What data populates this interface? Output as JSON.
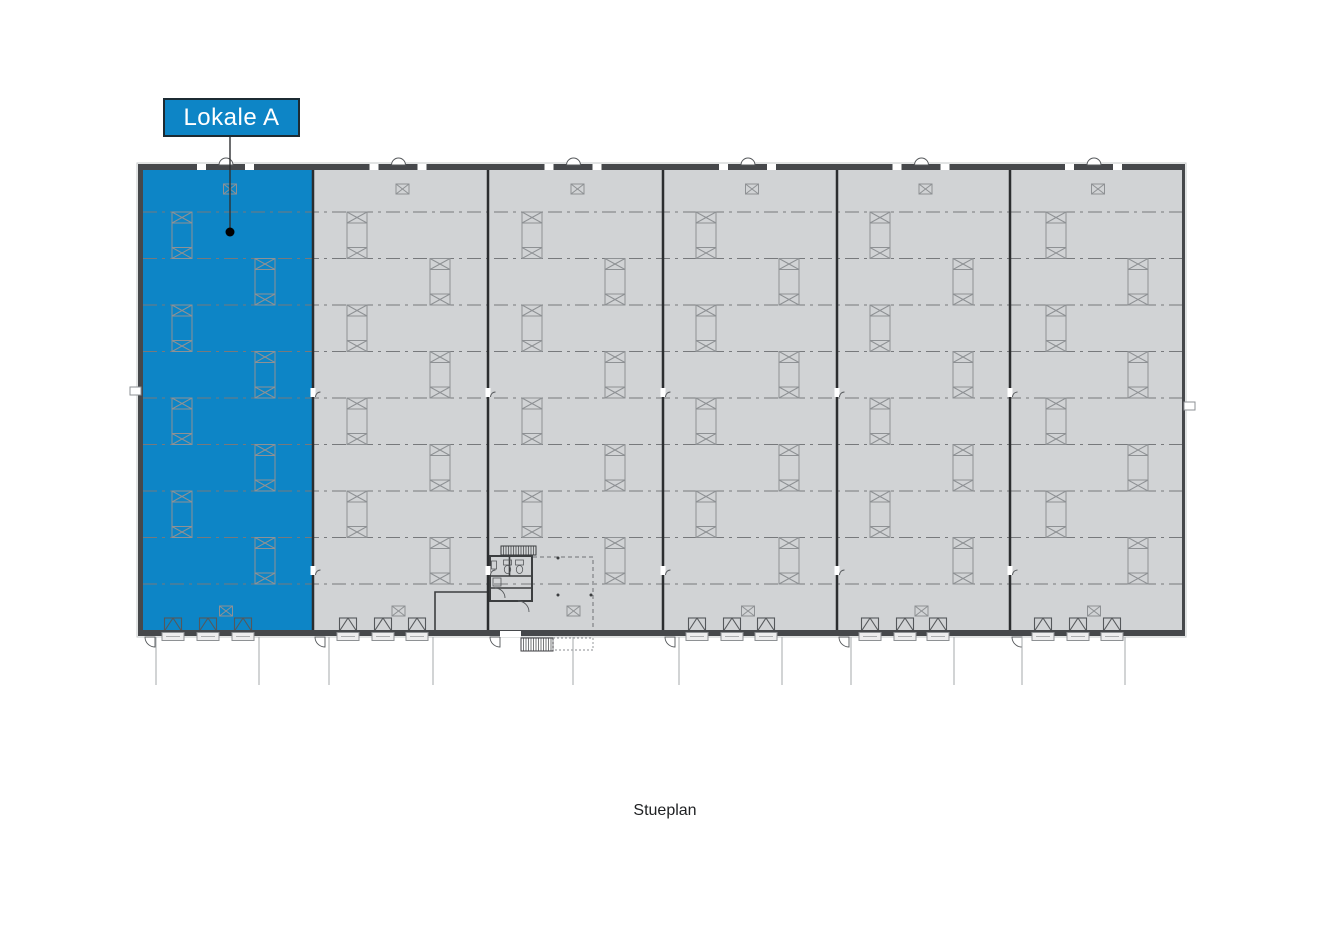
{
  "page": {
    "background": "#ffffff"
  },
  "label": {
    "text": "Lokale A",
    "text_color": "#ffffff",
    "fill": "#0d85c6",
    "border_color": "#1c2b33",
    "box": {
      "x": 163,
      "y": 98,
      "w": 137,
      "h": 39
    },
    "leader": {
      "x": 230,
      "y1": 137,
      "y2": 228,
      "dot_y": 232,
      "dot_r": 4.5
    }
  },
  "caption": {
    "text": "Stueplan",
    "x": 665,
    "y": 802
  },
  "plan": {
    "colors": {
      "highlight": "#0d85c6",
      "floor": "#d1d3d5",
      "wall": "#46484b",
      "wall_edge": "#c6c8ca",
      "divider": "#2b2d2f",
      "grid": "#77797c",
      "symbol": "#8e9194",
      "symbol_dark": "#55585b",
      "detail": "#3c3e40",
      "site_line": "#a4a8ab",
      "tray_fill": "#ededee",
      "leader": "#2e3032",
      "dot": "#000000"
    },
    "building": {
      "outer_x": 138,
      "outer_y": 164,
      "outer_w": 1047,
      "outer_h": 472,
      "wall": 6,
      "inner_x": 143,
      "inner_y": 170,
      "inner_r": 1182,
      "inner_b": 630
    },
    "grid": {
      "y_start": 212,
      "step": 46.5,
      "count": 9
    },
    "bays": [
      {
        "left": 143,
        "right": 313,
        "highlighted": true,
        "col_a": 182,
        "col_b": 265,
        "docks": [
          173,
          208,
          243
        ]
      },
      {
        "left": 313,
        "right": 488,
        "highlighted": false,
        "col_a": 357,
        "col_b": 440,
        "docks": [
          348,
          383,
          417
        ]
      },
      {
        "left": 488,
        "right": 663,
        "highlighted": false,
        "col_a": 532,
        "col_b": 615,
        "docks": []
      },
      {
        "left": 663,
        "right": 837,
        "highlighted": false,
        "col_a": 706,
        "col_b": 789,
        "docks": [
          697,
          732,
          766
        ]
      },
      {
        "left": 837,
        "right": 1010,
        "highlighted": false,
        "col_a": 880,
        "col_b": 963,
        "docks": [
          870,
          905,
          938
        ]
      },
      {
        "left": 1010,
        "right": 1182,
        "highlighted": false,
        "col_a": 1056,
        "col_b": 1138,
        "docks": [
          1043,
          1078,
          1112
        ]
      }
    ],
    "symbols": {
      "column_w": 20,
      "cap_h": 11,
      "xbox_w": 13,
      "xbox_h": 10,
      "xbox_top_y": 184,
      "xbox_bottom_y": 606
    },
    "divider_notch_y": [
      388,
      566
    ],
    "left_wall_notch_y": 387,
    "right_wall_notch_y": 402,
    "site_lines": {
      "x": [
        156,
        259,
        329,
        433,
        573,
        679,
        782,
        851,
        954,
        1022,
        1125
      ],
      "y1": 637,
      "y2": 685
    },
    "core": {
      "subroom": {
        "x": 435,
        "y": 592,
        "r": 488,
        "b": 631
      },
      "stair_top": {
        "x": 501,
        "y": 546,
        "w": 35,
        "h": 9
      },
      "room_block": {
        "x": 490,
        "y": 556,
        "w": 42,
        "h": 45
      },
      "inner_h_walls_y": [
        576,
        588
      ],
      "inner_v_wall": {
        "x": 509.5,
        "y1": 556,
        "y2": 576
      },
      "dashed_path": {
        "x1": 533,
        "y1": 557,
        "x2": 593,
        "y2": 630
      },
      "dots": [
        [
          558,
          558
        ],
        [
          558,
          595
        ],
        [
          591,
          595
        ]
      ],
      "wall_gap": {
        "x": 500,
        "y": 631,
        "w": 21,
        "h": 6
      },
      "ext_stair": {
        "x": 521,
        "y": 638,
        "w": 32,
        "h": 13
      },
      "ext_platform": {
        "x": 553,
        "y": 638,
        "w": 40,
        "h": 12
      }
    }
  }
}
